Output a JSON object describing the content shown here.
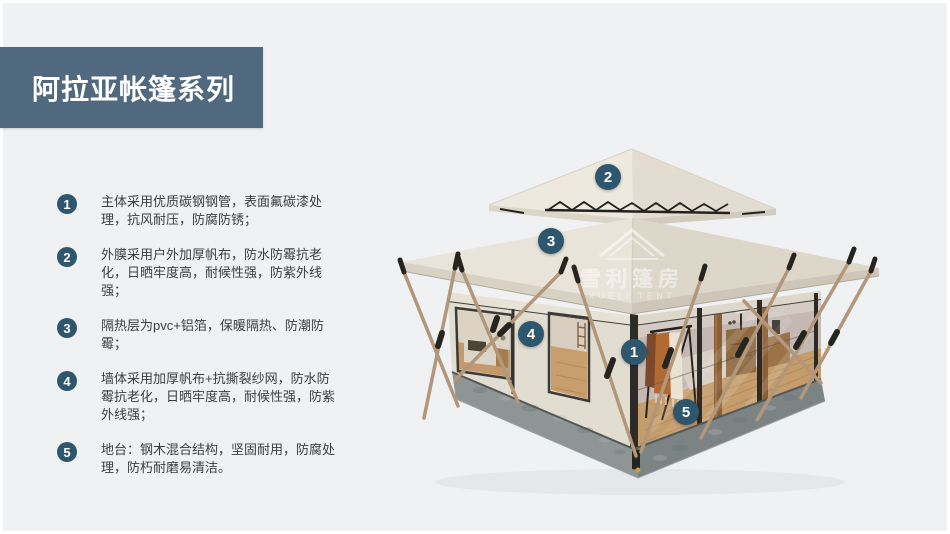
{
  "page": {
    "bg": "#f0f1f2",
    "frame": "#ffffff"
  },
  "header": {
    "title": "阿拉亚帐篷系列",
    "bg": "#50697e",
    "text_color": "#ffffff"
  },
  "features": [
    {
      "num": "1",
      "text": "主体采用优质碳钢钢管，表面氟碳漆处理，抗风耐压，防腐防锈；"
    },
    {
      "num": "2",
      "text": "外膜采用户外加厚帆布，防水防霉抗老化，日晒牢度高，耐候性强，防紫外线强；"
    },
    {
      "num": "3",
      "text": "隔热层为pvc+铝箔，保暖隔热、防潮防霉；"
    },
    {
      "num": "4",
      "text": "墙体采用加厚帆布+抗撕裂纱网，防水防霉抗老化，日晒牢度高，耐候性强，防紫外线强；"
    },
    {
      "num": "5",
      "text": "地台：钢木混合结构，坚固耐用，防腐处理，防朽耐磨易清洁。"
    }
  ],
  "diagram": {
    "marker_color": "#2e566d",
    "markers": [
      {
        "num": "1",
        "x": 634,
        "y": 352
      },
      {
        "num": "2",
        "x": 608,
        "y": 177
      },
      {
        "num": "3",
        "x": 551,
        "y": 241
      },
      {
        "num": "4",
        "x": 531,
        "y": 334
      },
      {
        "num": "5",
        "x": 686,
        "y": 412
      }
    ],
    "watermark": {
      "cn": "雪利篷房",
      "en": "XUELI TENT"
    }
  }
}
